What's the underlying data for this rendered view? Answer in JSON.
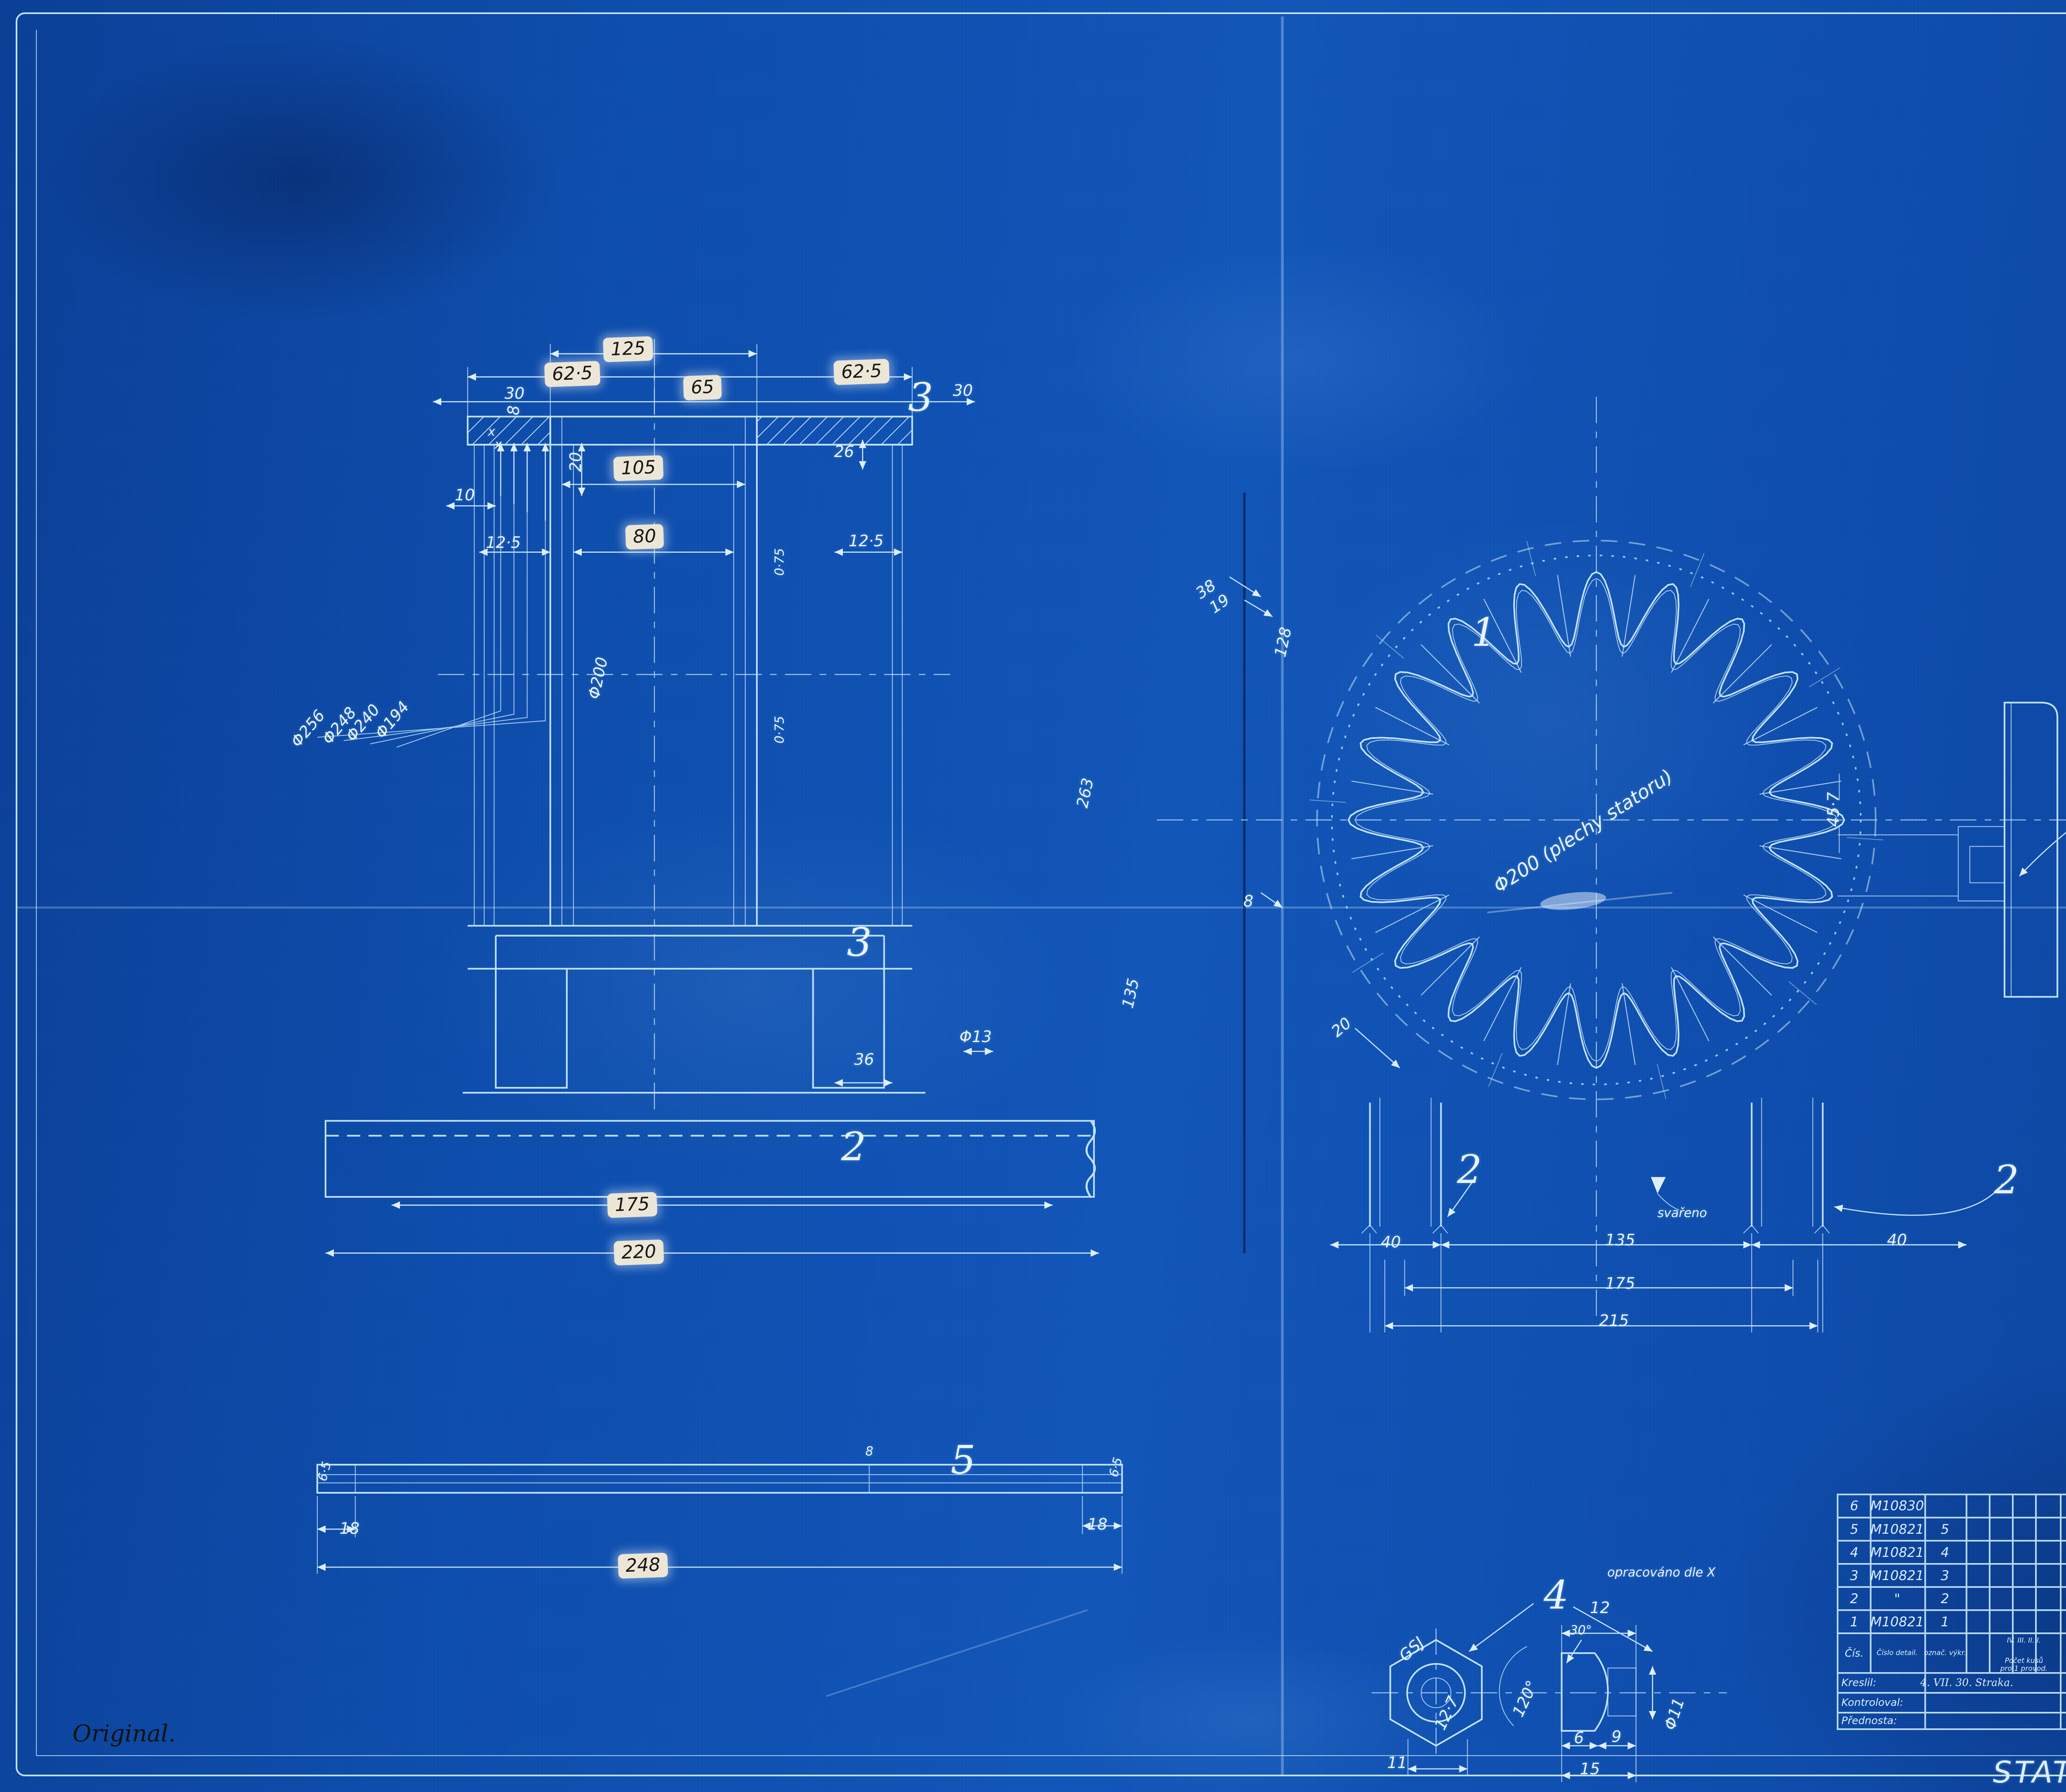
{
  "colors": {
    "paper_blue": "#0d4dac",
    "line_cyan": "#c3e4fb",
    "ink_white": "#e9f5ff",
    "patch_cream": "#ece6d6",
    "pen_black": "#14110d"
  },
  "ann": {
    "d125": "125",
    "d625l": "62·5",
    "d625r": "62·5",
    "d65": "65",
    "d30l": "30",
    "d30r": "30",
    "v3top": "3",
    "d8f": "8",
    "d10": "10",
    "d20f": "20",
    "d105": "105",
    "d26": "26",
    "xmark": "x",
    "d125a": "12·5",
    "d80": "80",
    "d125b": "12·5",
    "phi200": "Φ200",
    "phi256": "Φ256",
    "phi248": "Φ248",
    "phi240": "Φ240",
    "phi194": "Φ194",
    "d075": "0·75",
    "d128": "128",
    "d263": "263",
    "d135v": "135",
    "v3big": "3",
    "d36": "36",
    "phi13": "Φ13",
    "v2bar": "2",
    "d175bar": "175",
    "d220bar": "220",
    "v5": "5",
    "d8bar": "8",
    "d65e": "6·5",
    "d18l": "18",
    "d18r": "18",
    "d248": "248",
    "v1": "1",
    "phi200g": "Φ200 (plechy statoru)",
    "d38": "38",
    "d19": "19",
    "d8g": "8",
    "d20g": "20",
    "d457": "45·7",
    "v6": "6",
    "v2l": "2",
    "v2r": "2",
    "svareno": "svařeno",
    "d40l": "40",
    "d40r": "40",
    "d135g": "135",
    "d175g": "175",
    "d215g": "215",
    "v4": "4",
    "gsj": "GSJ",
    "d127": "12·7",
    "a120": "120°",
    "a30": "30°",
    "d12": "12",
    "oprac": "opracováno dle X",
    "phi11": "Φ11",
    "d6": "6",
    "d9": "9",
    "d15": "15",
    "d11": "11"
  },
  "table": {
    "rows": [
      {
        "cis": "6",
        "cislo": "M10830",
        "ozn": "",
        "text": "1 Svorková skříň.",
        "mat": "sest."
      },
      {
        "cis": "5",
        "cislo": "M10821",
        "ozn": "5",
        "text": "3 Šrouby GSJ",
        "patch": "×248",
        "mat": "K.Ž."
      },
      {
        "cis": "4",
        "cislo": "M10821",
        "ozn": "4",
        "text": "6 Matek GSJ",
        "mat": "\""
      },
      {
        "cis": "3",
        "cislo": "M10821",
        "ozn": "3",
        "text": "2 Stahovací pasy 30×755×8",
        "mat": "K.Ž."
      },
      {
        "cis": "2",
        "cislo": "\"",
        "ozn": "2",
        "text": "2 Patky statoru ⊔ 25/40/3",
        "patch": "220",
        "mat": "cc."
      },
      {
        "cis": "1",
        "cislo": "M10821",
        "ozn": "1",
        "text": "1 Válec statoru z vlnitého plechu.",
        "mat": "ž.pl. 0·75 cc"
      }
    ],
    "header": {
      "cis": "Čís.",
      "cislo": "Číslo detail.",
      "ozn": "označ. výkr.",
      "pocet": "IV. III. II. I.",
      "pocet2": "Počet kusů pro 1 provod.",
      "soucast": "SOUČÁST — POZNÁMKA.",
      "mat": "Materiál.",
      "model": "Číslo modelu.",
      "vaha": "Čistá váha 1 kusu."
    },
    "footer": {
      "kreslil": "Kreslil:",
      "kreslil_val": "4. VII. 30. Straka.",
      "meritko": "Měřítko 1:1.",
      "one": "1",
      "kontroloval": "Kontroloval:",
      "prednosta": "Přednosta:",
      "brand": "MEAS",
      "title": "STATOR",
      "title_sup": "B",
      "title_hand": "15aK/4",
      "number": "M 10907"
    }
  },
  "note": {
    "original": "Original."
  }
}
